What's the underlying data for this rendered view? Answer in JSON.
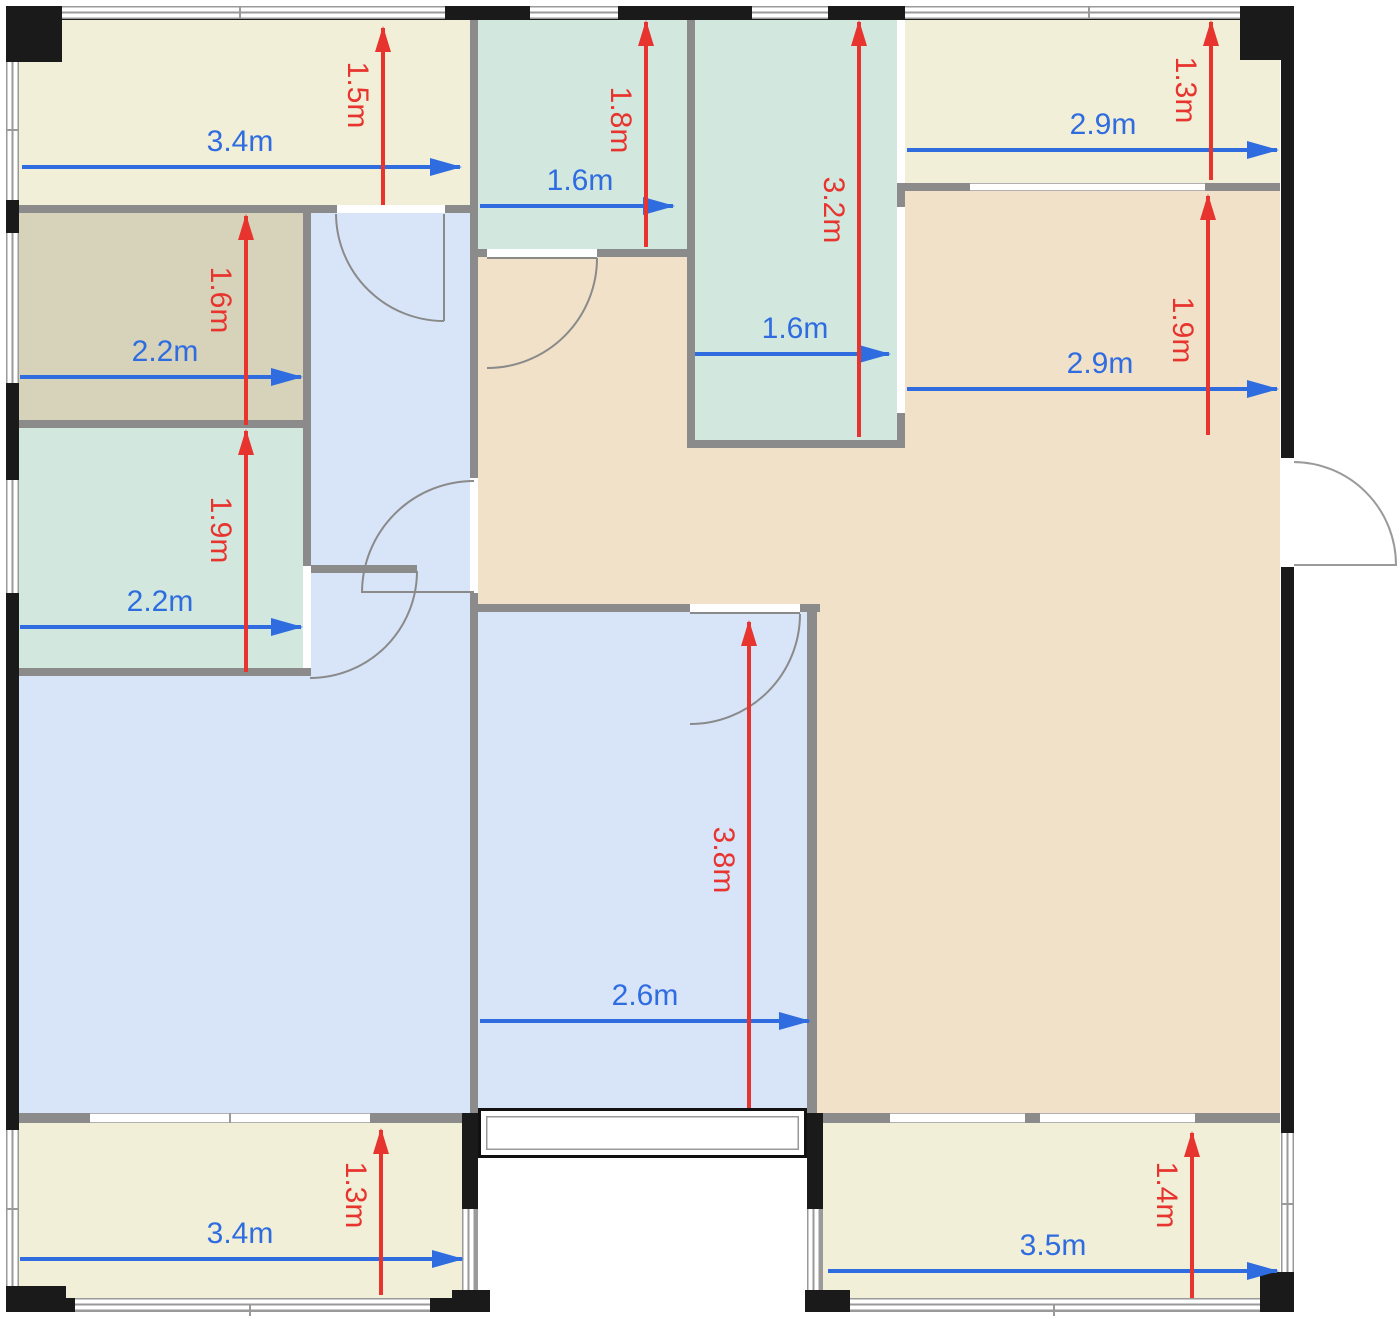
{
  "palette": {
    "balcony_fill": "#f1efd7",
    "storage_fill": "#d7d3ba",
    "bath_fill": "#d2e8de",
    "bedroom_fill": "#d8e4f8",
    "living_fill": "#f1e1c9",
    "wall_interior": "#8b8b8b",
    "wall_exterior": "#1a1a1a",
    "window_line": "#9a9a9a",
    "dim_h_color": "#2e6ce0",
    "dim_v_color": "#e8342e"
  },
  "dims_h": [
    {
      "label": "3.4m"
    },
    {
      "label": "2.2m"
    },
    {
      "label": "2.2m"
    },
    {
      "label": "1.6m"
    },
    {
      "label": "1.6m"
    },
    {
      "label": "2.9m"
    },
    {
      "label": "2.9m"
    },
    {
      "label": "2.6m"
    },
    {
      "label": "3.4m"
    },
    {
      "label": "3.5m"
    }
  ],
  "dims_v": [
    {
      "label": "1.5m"
    },
    {
      "label": "1.6m"
    },
    {
      "label": "1.9m"
    },
    {
      "label": "1.8m"
    },
    {
      "label": "3.2m"
    },
    {
      "label": "1.3m"
    },
    {
      "label": "1.9m"
    },
    {
      "label": "3.8m"
    },
    {
      "label": "1.3m"
    },
    {
      "label": "1.4m"
    }
  ]
}
